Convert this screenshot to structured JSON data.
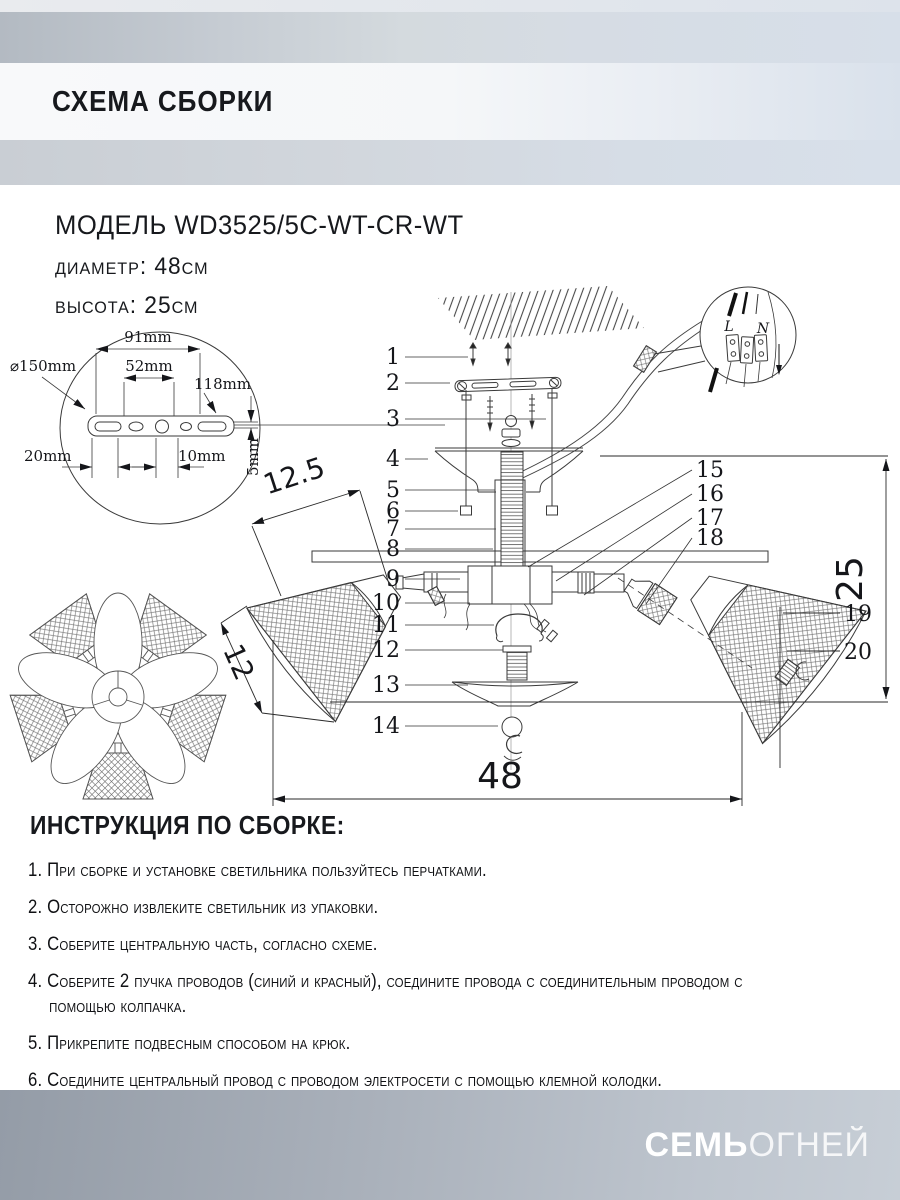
{
  "header": {
    "title": "СХЕМА СБОРКИ"
  },
  "model": {
    "line1": "МОДЕЛЬ WD3525/5C-WT-CR-WT",
    "diameter": "диаметр: 48см",
    "height": "высота: 25см"
  },
  "bracket_detail": {
    "diameter": "⌀150mm",
    "w91": "91mm",
    "w52": "52mm",
    "w118": "118mm",
    "w20": "20mm",
    "w10": "10mm",
    "t5": "5mm"
  },
  "diagram": {
    "parts": [
      "1",
      "2",
      "3",
      "4",
      "5",
      "6",
      "7",
      "8",
      "9",
      "10",
      "11",
      "12",
      "13",
      "14",
      "15",
      "16",
      "17",
      "18",
      "19",
      "20"
    ],
    "dims": {
      "total_width": "48",
      "total_height": "25",
      "shade_mouth": "12.5",
      "shade_depth": "12"
    },
    "terminal": {
      "live": "L",
      "neutral": "N"
    }
  },
  "instructions": {
    "title": "ИНСТРУКЦИЯ ПО СБОРКЕ:",
    "items": [
      "1. При сборке и установке светильника пользуйтесь перчатками.",
      "2. Осторожно извлеките светильник из упаковки.",
      "3. Соберите центральную часть, согласно схеме.",
      "4. Соберите 2 пучка проводов (синий и красный), соедините провода с соединительным проводом с помощью колпачка.",
      "5. Прикрепите подвесным способом на крюк.",
      "6. Соедините центральный провод с проводом электросети с помощью клемной колодки."
    ]
  },
  "footer": {
    "brand_bold": "СЕМЬ",
    "brand_light": "ОГНЕЙ"
  }
}
